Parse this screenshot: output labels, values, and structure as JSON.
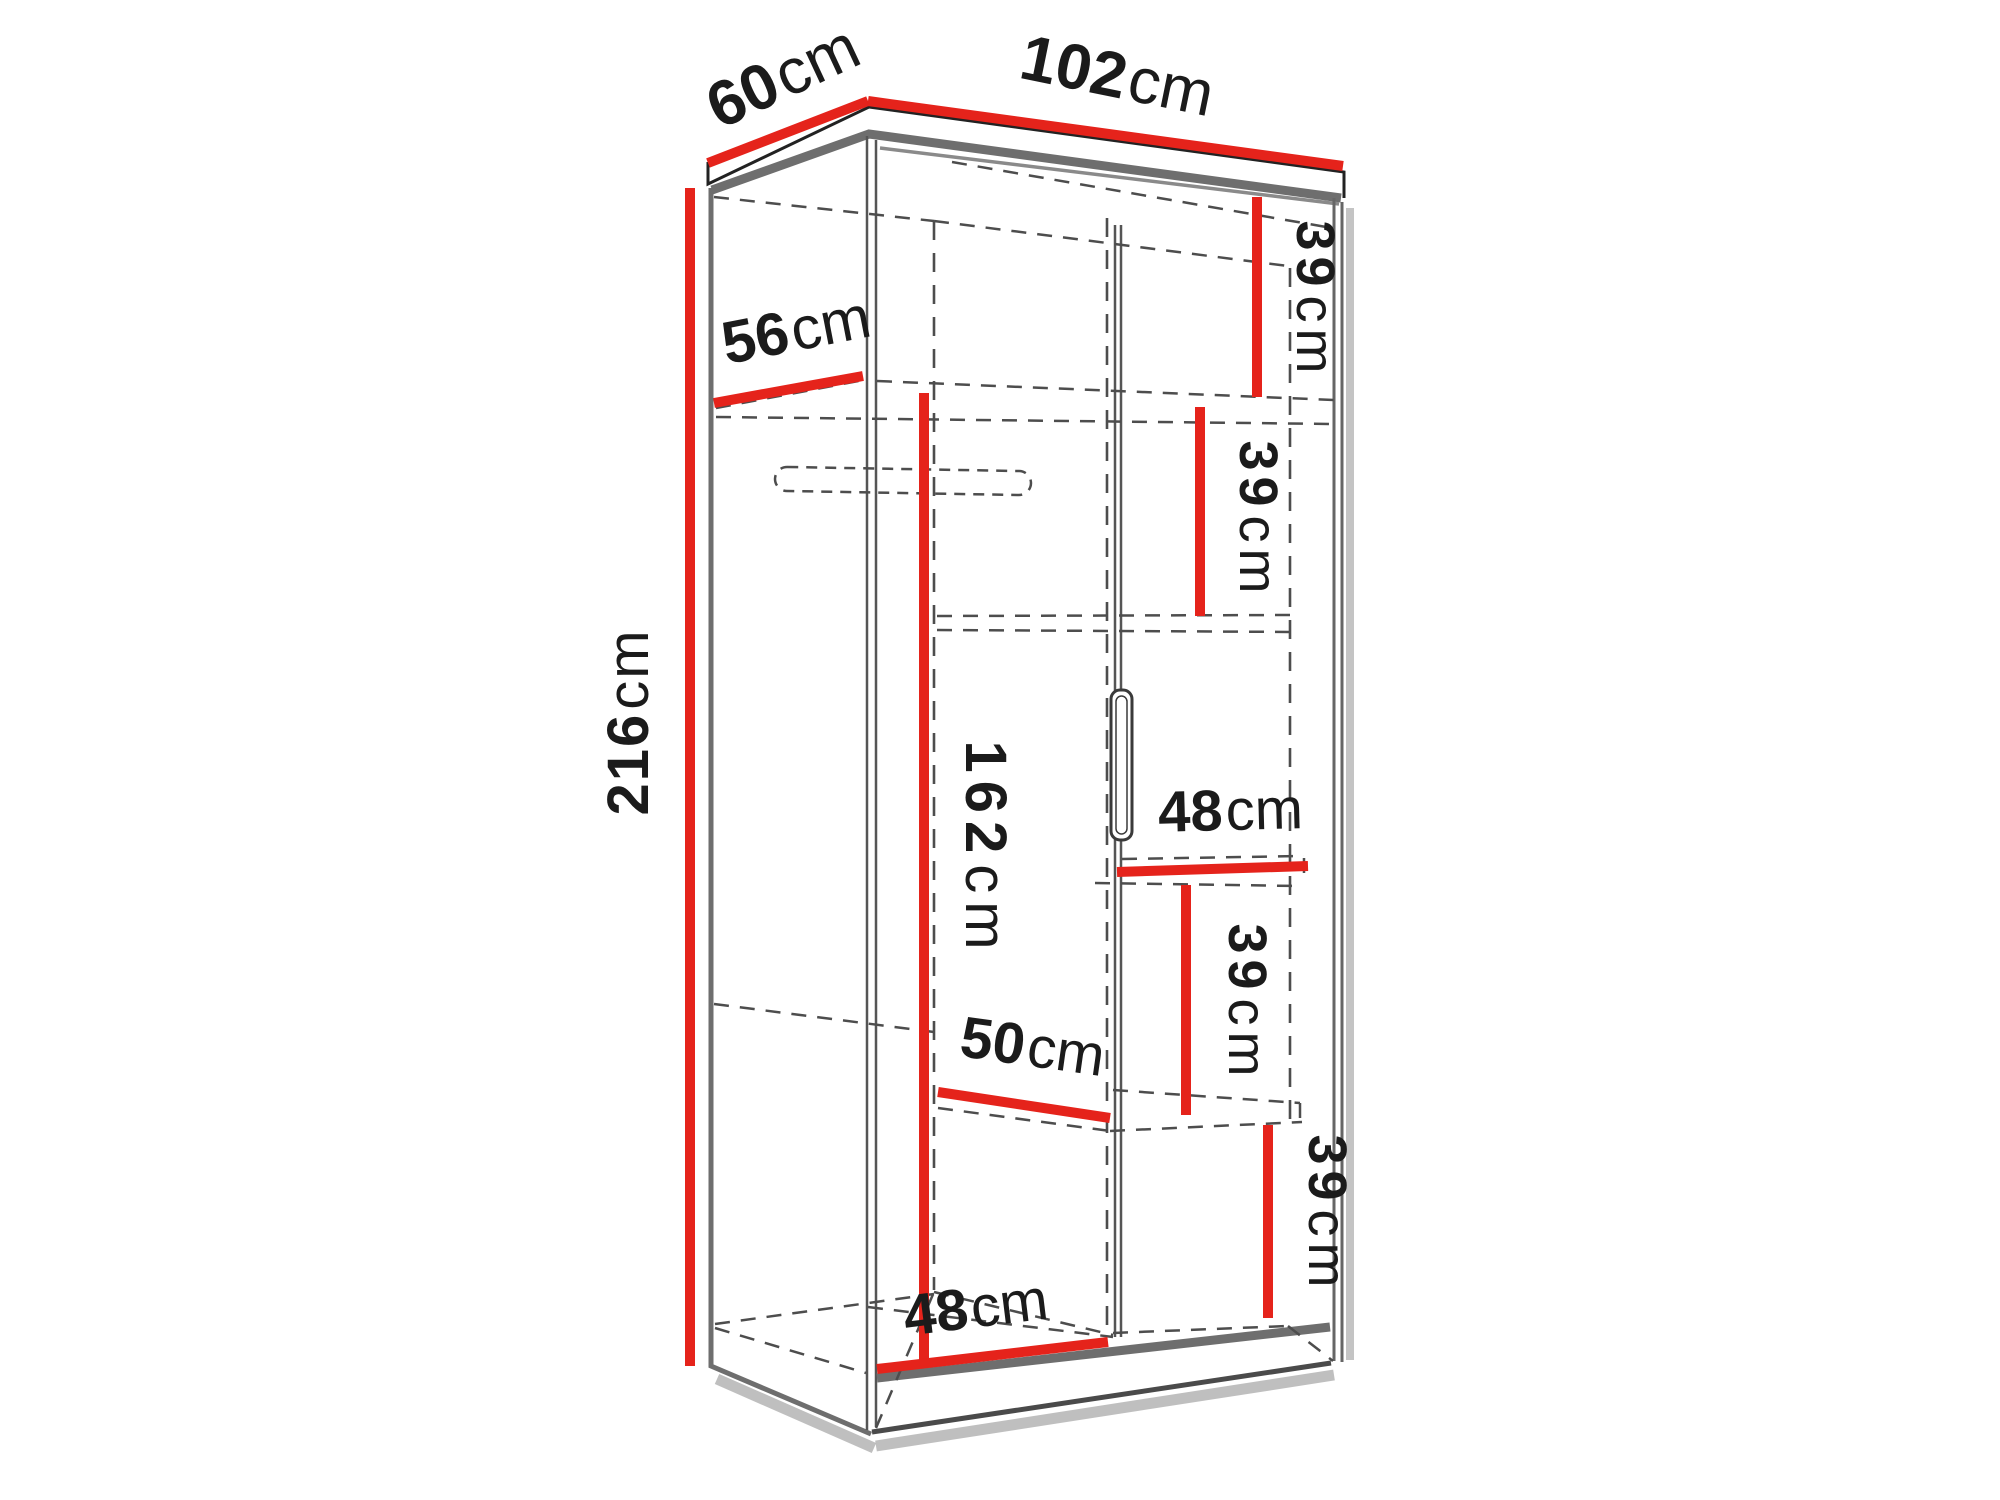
{
  "figure": {
    "kind": "wardrobe-dimension-diagram",
    "description": "Line drawing of a two-door wardrobe shown in perspective with red dimension lines and measurement labels"
  },
  "colors": {
    "dimension_line": "#e5231b",
    "outline_gray": "#6e6e6e",
    "hidden_edge_dash": "#4d4d4d",
    "label_text": "#1b1b1b",
    "background": "#ffffff"
  },
  "dimensions": {
    "depth_top": {
      "num": "60",
      "unit": "cm"
    },
    "width_top": {
      "num": "102",
      "unit": "cm"
    },
    "height_left": {
      "num": "216",
      "unit": "cm"
    },
    "interior_depth": {
      "num": "56",
      "unit": "cm"
    },
    "right_top_section_height": {
      "num": "39",
      "unit": "cm"
    },
    "right_second_section_height": {
      "num": "39",
      "unit": "cm"
    },
    "left_hanging_height": {
      "num": "162",
      "unit": "cm"
    },
    "right_shelf_width": {
      "num": "48",
      "unit": "cm"
    },
    "right_third_section_height": {
      "num": "39",
      "unit": "cm"
    },
    "left_shelf_width": {
      "num": "50",
      "unit": "cm"
    },
    "left_section_width": {
      "num": "48",
      "unit": "cm"
    },
    "right_bottom_section_height": {
      "num": "39",
      "unit": "cm"
    }
  }
}
